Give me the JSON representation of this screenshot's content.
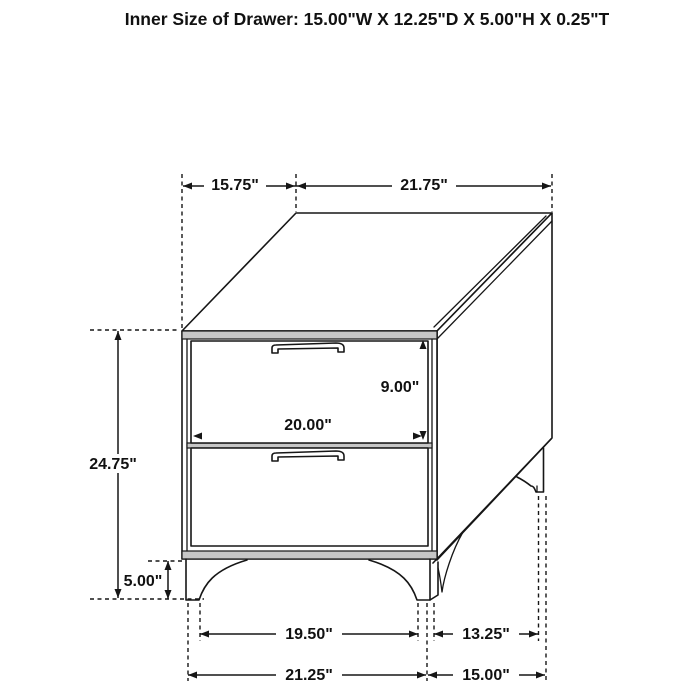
{
  "title": "Inner Size of Drawer: 15.00\"W X 12.25\"D X 5.00\"H X 0.25\"T",
  "dimensions": {
    "top_depth": "15.75\"",
    "top_width": "21.75\"",
    "overall_height": "24.75\"",
    "leg_height": "5.00\"",
    "drawer_front_height": "9.00\"",
    "drawer_front_width": "20.00\"",
    "front_legs_inner_span": "19.50\"",
    "side_legs_span": "13.25\"",
    "base_width": "21.25\"",
    "base_depth": "15.00\""
  }
}
